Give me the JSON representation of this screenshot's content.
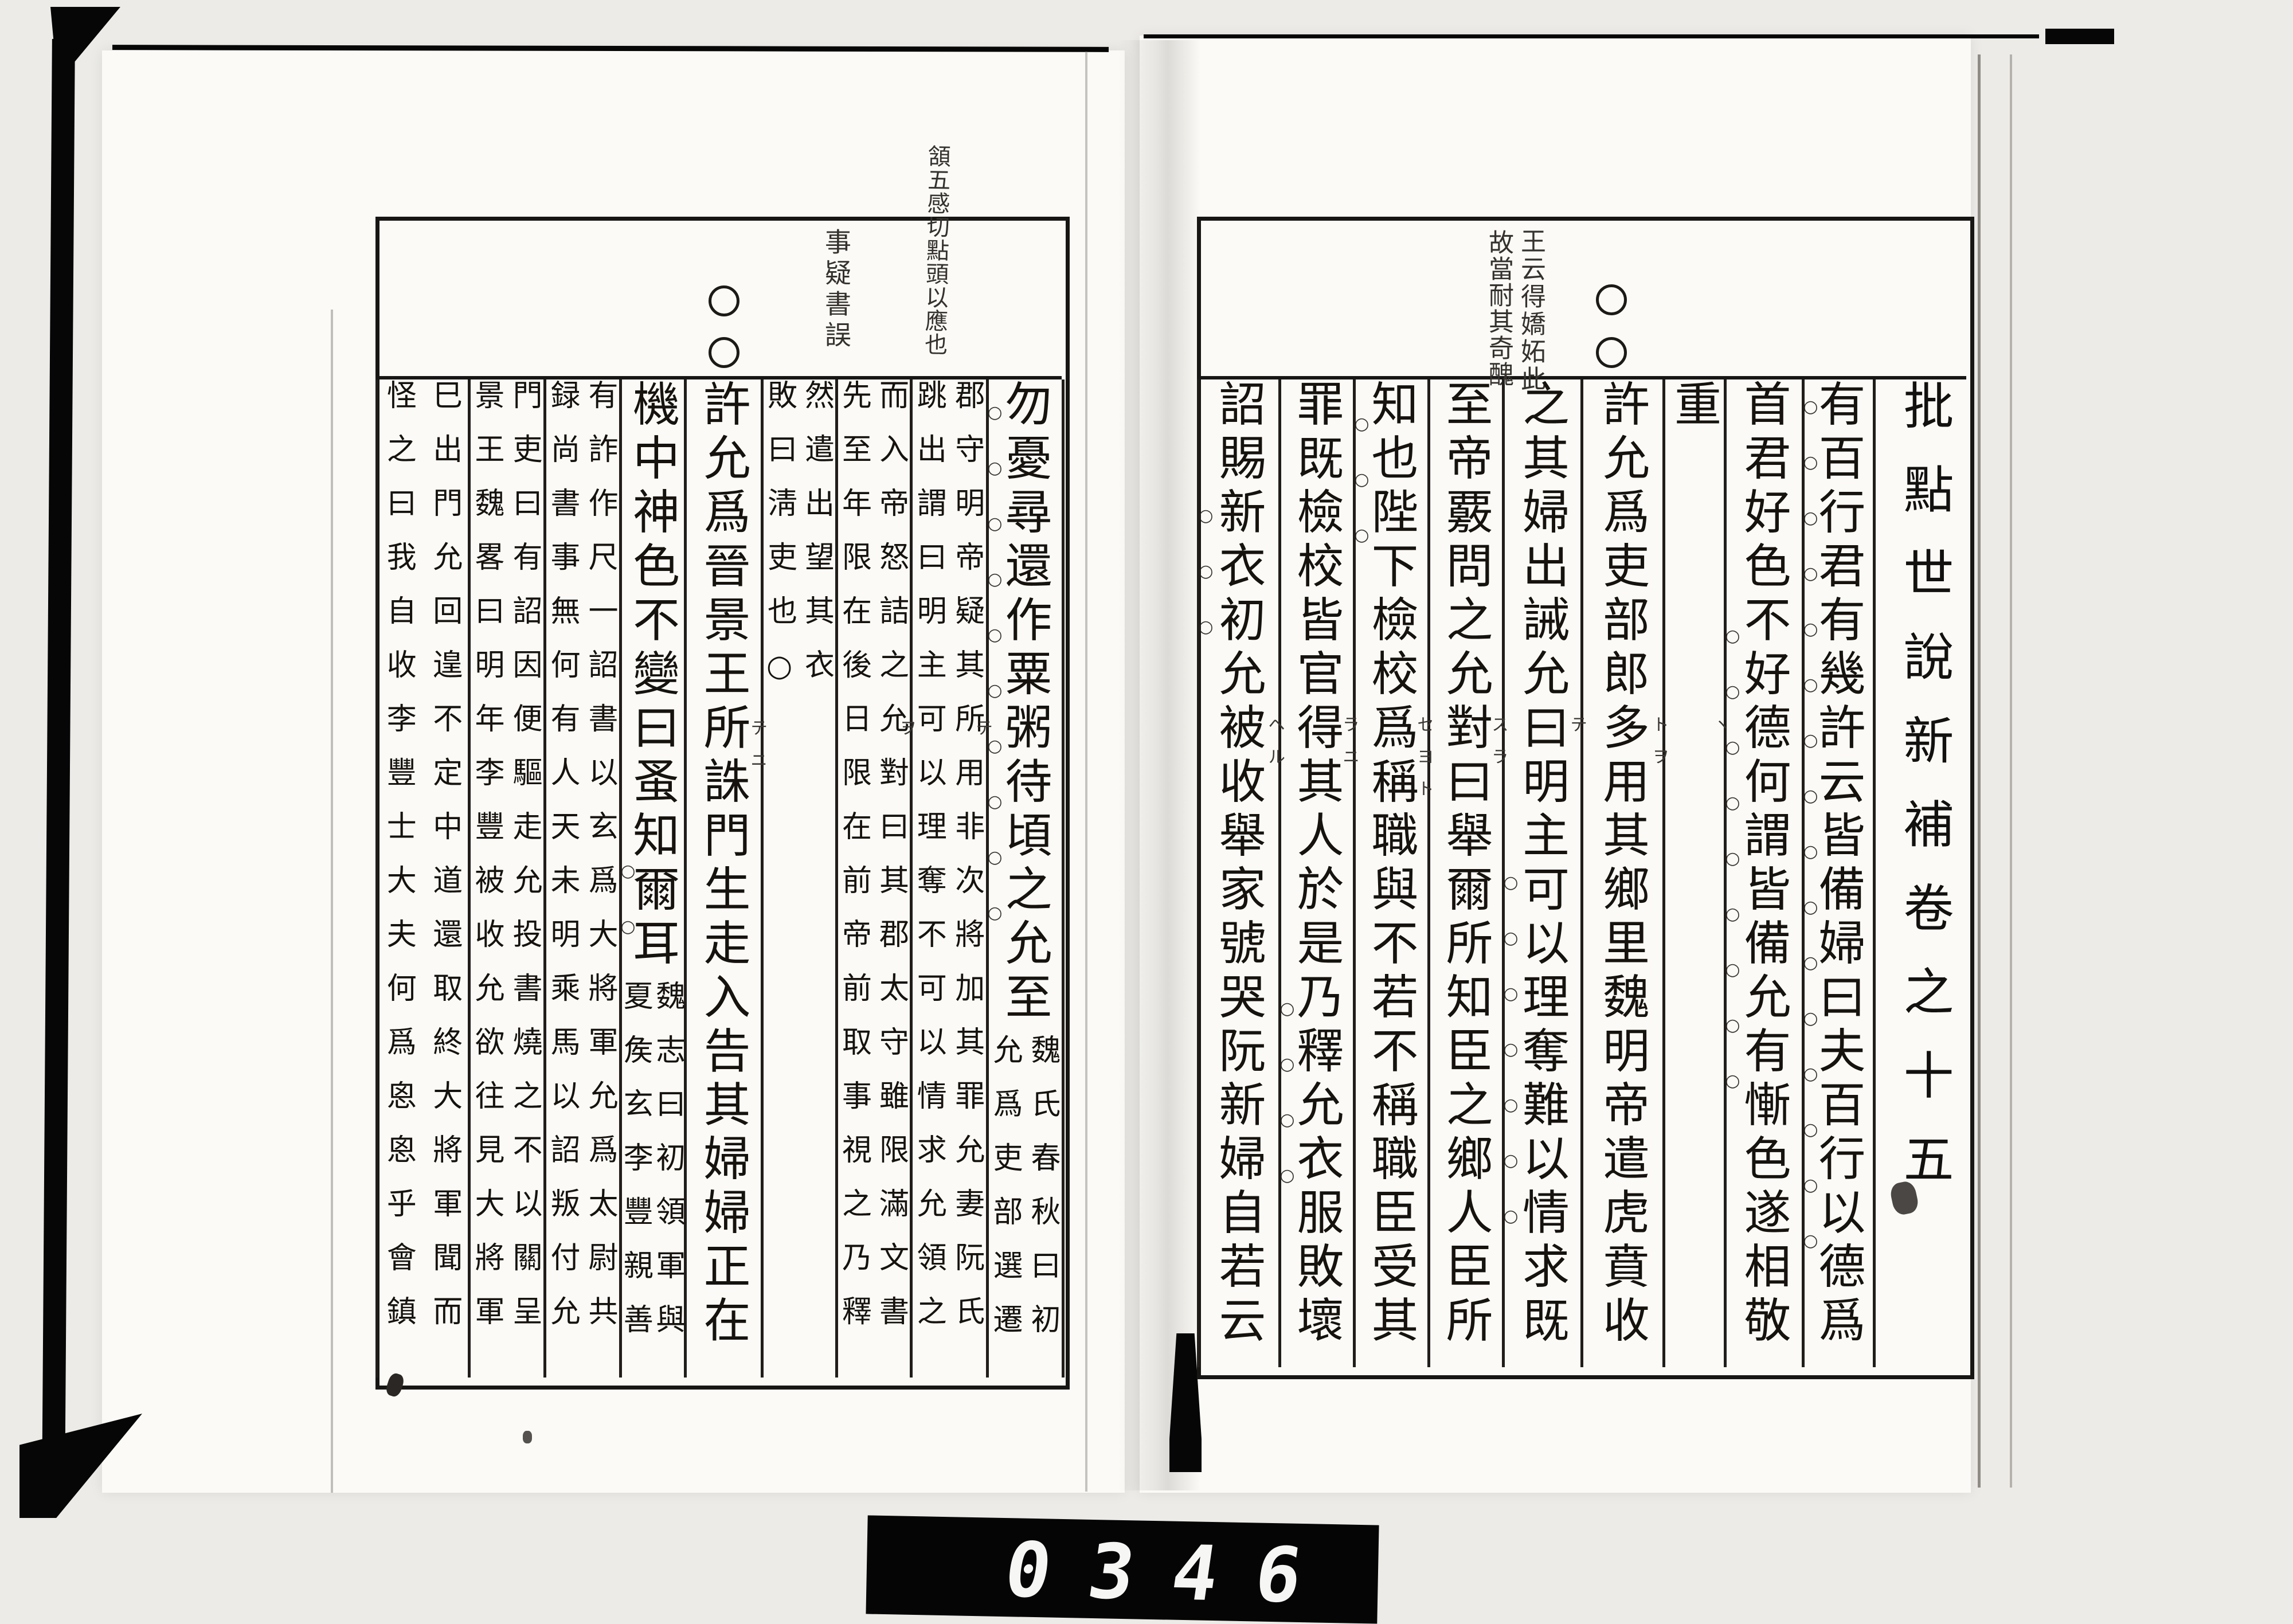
{
  "scanner": {
    "counter": "0346"
  },
  "book": {
    "right_page": {
      "spine_title": "批點世說新補卷之十五",
      "margin_notes": [
        "王云得嬌妬此",
        "故當耐其奇醜"
      ],
      "story_marker": "○○",
      "columns": [
        {
          "style": "large",
          "text": "有百行君有幾許云皆備婦曰夫百行以德爲",
          "emphasis_circles": 16
        },
        {
          "style": "large",
          "text": "首君好色不好德何謂皆備允有慚色遂相敬",
          "emphasis_circles": 9
        },
        {
          "style": "large",
          "text": "重",
          "reading_marks": "ヽ"
        },
        {
          "style": "large",
          "text": "許允爲吏部郎多用其鄉里魏明帝遣虎賁收",
          "reading_marks": "トヲ"
        },
        {
          "style": "large",
          "text": "之其婦出誡允曰明主可以理奪難以情求既",
          "emphasis_circles": 7,
          "reading_marks": "テ"
        },
        {
          "style": "large",
          "text": "至帝覈問之允對曰舉爾所知臣之鄉人臣所",
          "reading_marks": "スラ"
        },
        {
          "style": "large",
          "text": "知也陛下檢校爲稱職與不若不稱職臣受其",
          "emphasis_circles": 3,
          "reading_marks": "セヨト"
        },
        {
          "style": "large",
          "text": "罪既檢校皆官得其人於是乃釋允衣服敗壞",
          "emphasis_circles": 4,
          "reading_marks": "ラニ"
        },
        {
          "style": "large",
          "text": "詔賜新衣初允被收舉家號哭阮新婦自若云",
          "emphasis_circles": 3,
          "reading_marks": "ヘル"
        }
      ]
    },
    "left_page": {
      "margin_notes": [
        "頷五感切點頭以應也",
        "事疑書誤"
      ],
      "story_marker": "○○",
      "columns": [
        {
          "style": "mixed",
          "text": "勿憂尋還作粟粥待頃之允至",
          "note_right": "魏氏春秋曰初",
          "note_left": "允爲吏部選遷",
          "emphasis_circles": 10
        },
        {
          "style": "note",
          "note_right": "郡守明帝疑其所用非次將加其罪允妻阮氏",
          "note_left": "跳出謂曰明主可以理奪不可以情求允領之",
          "reading_marks": "テ"
        },
        {
          "style": "note",
          "note_right": "而入帝怒詰之允對曰其郡太守雖限滿文書",
          "note_left": "先至年限在後日限在前帝前取事視之乃釋",
          "reading_marks": "ヲ"
        },
        {
          "style": "note",
          "note_right": "然遣出望其衣",
          "note_left": "敗曰淸吏也○"
        },
        {
          "style": "large",
          "text": "許允爲晉景王所誅門生走入告其婦婦正在",
          "reading_marks": "テニ"
        },
        {
          "style": "mixed",
          "text": "機中神色不變曰蚤知爾耳",
          "note_right": "魏志曰初領軍與",
          "note_left": "夏矦玄李豐親善",
          "emphasis_circles": 2
        },
        {
          "style": "note",
          "note_right": "有詐作尺一詔書以玄爲大將軍允爲太尉共",
          "note_left": "録尚書事無何有人天未明乘馬以詔叛付允"
        },
        {
          "style": "note",
          "note_right": "門吏曰有詔因便驅走允投書燒之不以關呈",
          "note_left": "景王魏畧曰明年李豐被收允欲往見大將軍"
        },
        {
          "style": "note",
          "note_right": "巳出門允回遑不定中道還取終大將軍聞而",
          "note_left": "怪之曰我自收李豐士大夫何爲恖恖乎會鎮"
        }
      ]
    }
  }
}
